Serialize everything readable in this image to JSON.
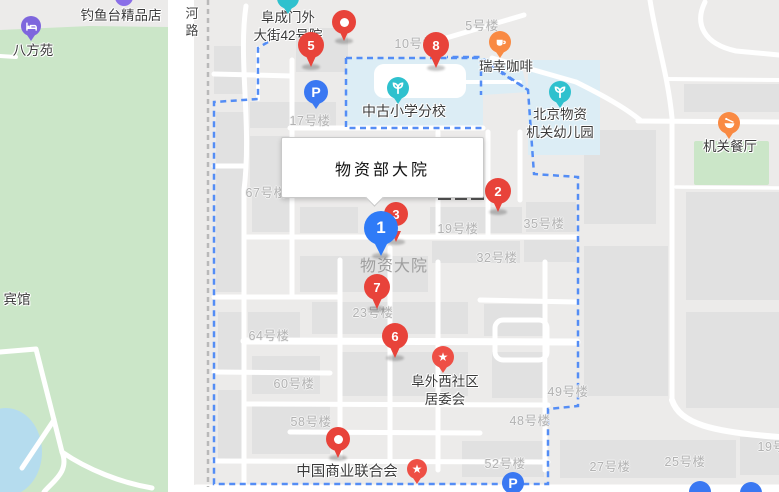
{
  "map": {
    "selected_place": {
      "label": "物资部大院"
    },
    "colors": {
      "marker_red": "#e8433a",
      "marker_blue": "#2f7bf7",
      "boundary_blue": "#548df5",
      "park_green": "#cbe6c8",
      "school_fill": "#dcedf5",
      "water_blue": "#b5dcee",
      "teal": "#2fc1ce",
      "orange": "#f98a43",
      "poi_red": "#ee4f45",
      "purple": "#7e66dd",
      "parking_blue": "#3a78f2"
    },
    "poi_labels": [
      {
        "name": "label-diaoyutai-boutique",
        "lines": [
          "钓鱼台精品店"
        ],
        "x": 121,
        "y": 7
      },
      {
        "name": "label-bafangyuan",
        "lines": [
          "八方苑"
        ],
        "x": 33,
        "y": 42
      },
      {
        "name": "label-fuchengmenwai-dajie-42",
        "lines": [
          "阜成门外",
          "大街42号院"
        ],
        "x": 288,
        "y": 9
      },
      {
        "name": "label-zhonggu-primary-school",
        "lines": [
          "中古小学分校"
        ],
        "x": 404,
        "y": 102,
        "size": 14
      },
      {
        "name": "label-luckin-coffee",
        "lines": [
          "瑞幸咖啡"
        ],
        "x": 506,
        "y": 58
      },
      {
        "name": "label-beijing-wuzi-kindergarten",
        "lines": [
          "北京物资",
          "机关幼儿园"
        ],
        "x": 560,
        "y": 106
      },
      {
        "name": "label-jiguan-canteen",
        "lines": [
          "机关餐厅"
        ],
        "x": 730,
        "y": 138
      },
      {
        "name": "label-hotel",
        "lines": [
          "宾馆"
        ],
        "x": 17,
        "y": 291
      },
      {
        "name": "label-fuwaixi-community",
        "lines": [
          "阜外西社区",
          "居委会"
        ],
        "x": 445,
        "y": 373
      },
      {
        "name": "label-china-commerce-federation",
        "lines": [
          "中国商业联合会"
        ],
        "x": 347,
        "y": 463,
        "size": 14.5
      },
      {
        "name": "label-wuzi-dayuan",
        "lines": [
          "物资大院"
        ],
        "x": 394,
        "y": 256,
        "variant": "area"
      },
      {
        "name": "label-helu-road",
        "lines": [
          "河",
          "路"
        ],
        "x": 192,
        "y": 5,
        "variant": "road"
      }
    ],
    "building_labels": [
      {
        "t": "5号楼",
        "x": 482,
        "y": 15
      },
      {
        "t": "10号楼",
        "x": 415,
        "y": 33
      },
      {
        "t": "17号楼",
        "x": 310,
        "y": 110
      },
      {
        "t": "67号楼",
        "x": 266,
        "y": 182
      },
      {
        "t": "19号楼",
        "x": 458,
        "y": 218
      },
      {
        "t": "35号楼",
        "x": 544,
        "y": 213
      },
      {
        "t": "32号楼",
        "x": 497,
        "y": 247
      },
      {
        "t": "64号楼",
        "x": 269,
        "y": 325
      },
      {
        "t": "23号楼",
        "x": 373,
        "y": 302
      },
      {
        "t": "60号楼",
        "x": 294,
        "y": 373
      },
      {
        "t": "58号楼",
        "x": 311,
        "y": 411
      },
      {
        "t": "49号楼",
        "x": 568,
        "y": 381
      },
      {
        "t": "48号楼",
        "x": 530,
        "y": 410
      },
      {
        "t": "52号楼",
        "x": 505,
        "y": 453
      },
      {
        "t": "27号楼",
        "x": 610,
        "y": 456
      },
      {
        "t": "25号楼",
        "x": 685,
        "y": 451
      },
      {
        "t": "19号楼",
        "x": 778,
        "y": 436
      }
    ],
    "markers": [
      {
        "id": "marker-5",
        "label": "5",
        "type": "red",
        "x": 311,
        "y": 45,
        "r": 13,
        "tip": 67
      },
      {
        "id": "poi-pin-top",
        "label": "",
        "type": "red-dot",
        "x": 344,
        "y": 22,
        "r": 12,
        "tip": 41
      },
      {
        "id": "marker-8",
        "label": "8",
        "type": "red",
        "x": 436,
        "y": 45,
        "r": 13,
        "tip": 68
      },
      {
        "id": "marker-2",
        "label": "2",
        "type": "red",
        "x": 498,
        "y": 191,
        "r": 13,
        "tip": 212
      },
      {
        "id": "marker-3",
        "label": "3",
        "type": "red",
        "x": 396,
        "y": 214,
        "r": 12,
        "tip": 242
      },
      {
        "id": "marker-7",
        "label": "7",
        "type": "red",
        "x": 377,
        "y": 287,
        "r": 13,
        "tip": 309
      },
      {
        "id": "marker-6",
        "label": "6",
        "type": "red",
        "x": 395,
        "y": 336,
        "r": 13,
        "tip": 358
      },
      {
        "id": "poi-pin-bottom",
        "label": "",
        "type": "red-dot",
        "x": 338,
        "y": 439,
        "r": 12,
        "tip": 458
      },
      {
        "id": "marker-1",
        "label": "1",
        "type": "blue",
        "x": 381,
        "y": 228,
        "r": 17,
        "tip": 256
      }
    ],
    "icons": [
      {
        "name": "hotel-bed-icon",
        "glyph": "bed",
        "color": "#7e66dd",
        "x": 31,
        "y": 26,
        "r": 10,
        "tail": true
      },
      {
        "name": "poi-pin-clipped-icon",
        "glyph": "plain",
        "color": "#8a6fe8",
        "x": 124,
        "y": -3,
        "r": 9,
        "tail": false
      },
      {
        "name": "teal-poi-clipped-icon",
        "glyph": "plain",
        "color": "#2fc1ce",
        "x": 288,
        "y": -2,
        "r": 11,
        "tail": true
      },
      {
        "name": "parking-icon",
        "glyph": "parking",
        "color": "#3a78f2",
        "x": 316,
        "y": 92,
        "r": 12,
        "tail": true
      },
      {
        "name": "school-sprout-icon",
        "glyph": "sprout",
        "color": "#2fc1ce",
        "x": 398,
        "y": 88,
        "r": 11,
        "tail": true
      },
      {
        "name": "coffee-cup-icon",
        "glyph": "coffee",
        "color": "#f98a43",
        "x": 500,
        "y": 42,
        "r": 11,
        "tail": true
      },
      {
        "name": "kindergarten-sprout-icon",
        "glyph": "sprout",
        "color": "#2fc1ce",
        "x": 560,
        "y": 92,
        "r": 11,
        "tail": true
      },
      {
        "name": "restaurant-bowl-icon",
        "glyph": "restaurant",
        "color": "#f98a43",
        "x": 729,
        "y": 123,
        "r": 11,
        "tail": true
      },
      {
        "name": "community-star-icon",
        "glyph": "star",
        "color": "#ee4f45",
        "x": 443,
        "y": 357,
        "r": 11,
        "tail": true
      },
      {
        "name": "federation-star-icon",
        "glyph": "star",
        "color": "#ee4f45",
        "x": 417,
        "y": 469,
        "r": 10,
        "tail": true
      },
      {
        "name": "parking-bottom-icon",
        "glyph": "parking",
        "color": "#3a78f2",
        "x": 513,
        "y": 483,
        "r": 11,
        "tail": false
      },
      {
        "name": "blue-poi-edge-icon",
        "glyph": "plain",
        "color": "#3a78f2",
        "x": 700,
        "y": 492,
        "r": 11,
        "tail": false
      },
      {
        "name": "blue-poi-edge-icon",
        "glyph": "plain",
        "color": "#3a78f2",
        "x": 751,
        "y": 493,
        "r": 11,
        "tail": false
      }
    ]
  }
}
